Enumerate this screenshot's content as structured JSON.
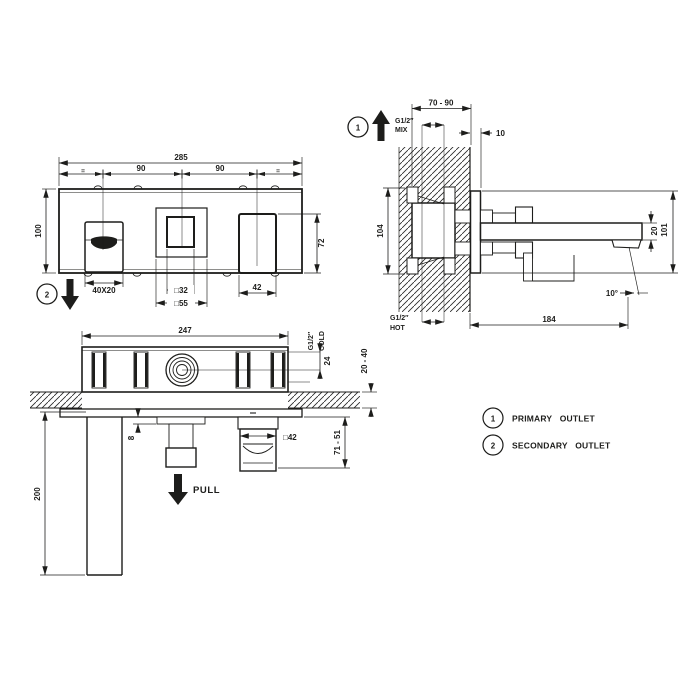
{
  "colors": {
    "line": "#1d1d1b",
    "background": "#ffffff"
  },
  "front_view": {
    "marker": "2",
    "overall_width": "285",
    "left_spacing": "90",
    "right_spacing": "90",
    "equal_left": "=",
    "equal_right": "=",
    "plate_height": "100",
    "handle_height": "72",
    "outlet_slot": "40X20",
    "knob_size": "□32",
    "escutcheon_size": "□55",
    "handle_width": "42"
  },
  "side_view": {
    "marker": "1",
    "embed_depth_range": "70 - 90",
    "mix_thread": "G1/2″",
    "mix_label": "MIX",
    "flange_depth": "10",
    "body_height": "104",
    "spout_thickness": "20",
    "overall_height": "101",
    "spout_angle": "10°",
    "spout_reach": "184",
    "hot_thread": "G1/2″",
    "hot_label": "HOT"
  },
  "plan_view": {
    "body_width": "247",
    "cold_thread": "G1/2″",
    "cold_label": "COLD",
    "cold_offset": "24",
    "wall_thickness_range": "20 - 40",
    "spout_length": "200",
    "step_depth": "8",
    "pull_label": "PULL",
    "handspray_size": "□42",
    "projection_range": "71 - 51"
  },
  "legend": {
    "items": [
      {
        "marker": "1",
        "label": "PRIMARY OUTLET"
      },
      {
        "marker": "2",
        "label": "SECONDARY OUTLET"
      }
    ]
  }
}
